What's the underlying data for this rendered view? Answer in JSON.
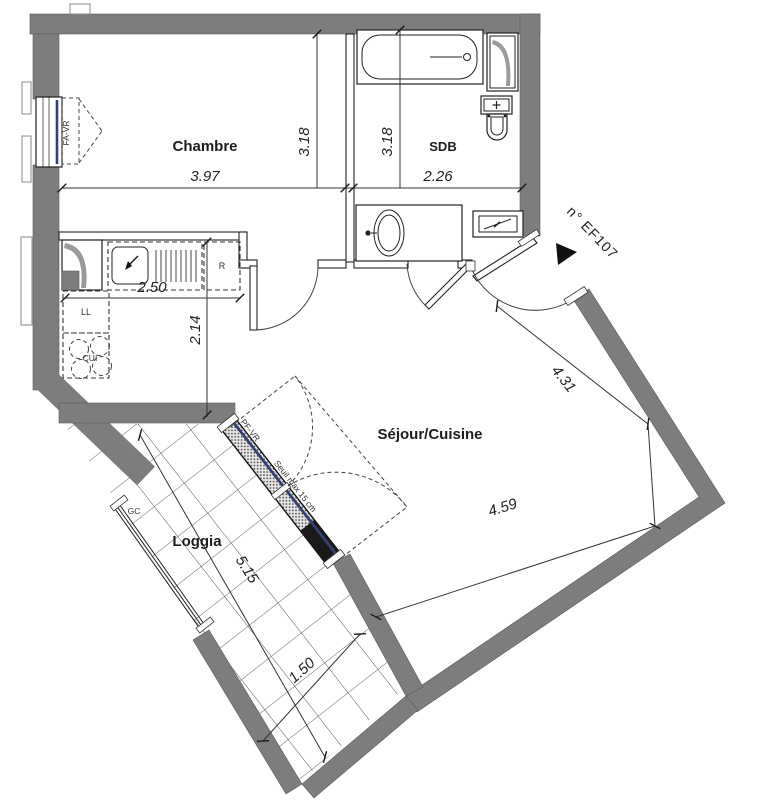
{
  "plan": {
    "unit_label": "n° EF107",
    "rooms": {
      "bedroom": "Chambre",
      "bathroom": "SDB",
      "living_kitchen": "Séjour/Cuisine",
      "loggia": "Loggia"
    },
    "dimensions": {
      "bedroom_width": "3.97",
      "bedroom_depth": "3.18",
      "bathroom_depth": "3.18",
      "bathroom_width": "2.26",
      "kitchen_width": "2.50",
      "kitchen_depth": "2.14",
      "living_side_right": "4.31",
      "living_side_bottom": "4.59",
      "loggia_length": "5.15",
      "loggia_width": "1.50"
    },
    "labels": {
      "bedroom_window": "FA-VR",
      "loggia_window": "PF-VR",
      "threshold_note": "Seuil max 15 cm",
      "gutter": "GC",
      "washing_machine": "LL",
      "cooker": "CUI",
      "fridge": "R"
    },
    "colors": {
      "wall_gray": "#7d7d7d",
      "glazing_blue": "#35406e",
      "line_black": "#222222"
    }
  }
}
